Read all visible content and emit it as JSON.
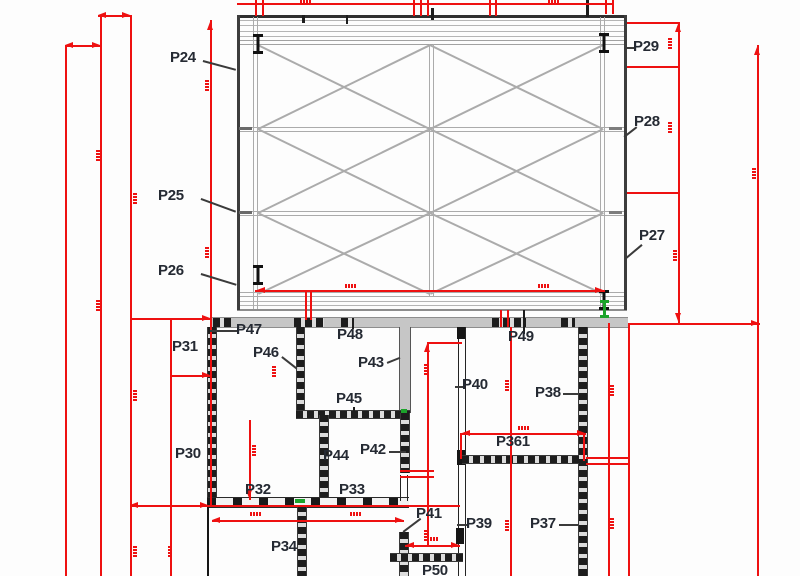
{
  "drawing": {
    "kind": "structural framing and wall plan",
    "colors": {
      "dimension_red": "#ee1111",
      "wall_ink": "#1d1d1d",
      "frame_gray": "#ababab",
      "band_gray": "#c6c6c6",
      "label_ink": "#252a33",
      "survey_green": "#1ca32b"
    }
  },
  "labels": [
    {
      "text": "P24"
    },
    {
      "text": "P25"
    },
    {
      "text": "P26"
    },
    {
      "text": "P27"
    },
    {
      "text": "P28"
    },
    {
      "text": "P29"
    },
    {
      "text": "P30"
    },
    {
      "text": "P31"
    },
    {
      "text": "P32"
    },
    {
      "text": "P33"
    },
    {
      "text": "P34"
    },
    {
      "text": "P37"
    },
    {
      "text": "P38"
    },
    {
      "text": "P39"
    },
    {
      "text": "P40"
    },
    {
      "text": "P41"
    },
    {
      "text": "P42"
    },
    {
      "text": "P43"
    },
    {
      "text": "P44"
    },
    {
      "text": "P45"
    },
    {
      "text": "P46"
    },
    {
      "text": "P47"
    },
    {
      "text": "P48"
    },
    {
      "text": "P49"
    },
    {
      "text": "P361"
    },
    {
      "text": "P50"
    }
  ]
}
